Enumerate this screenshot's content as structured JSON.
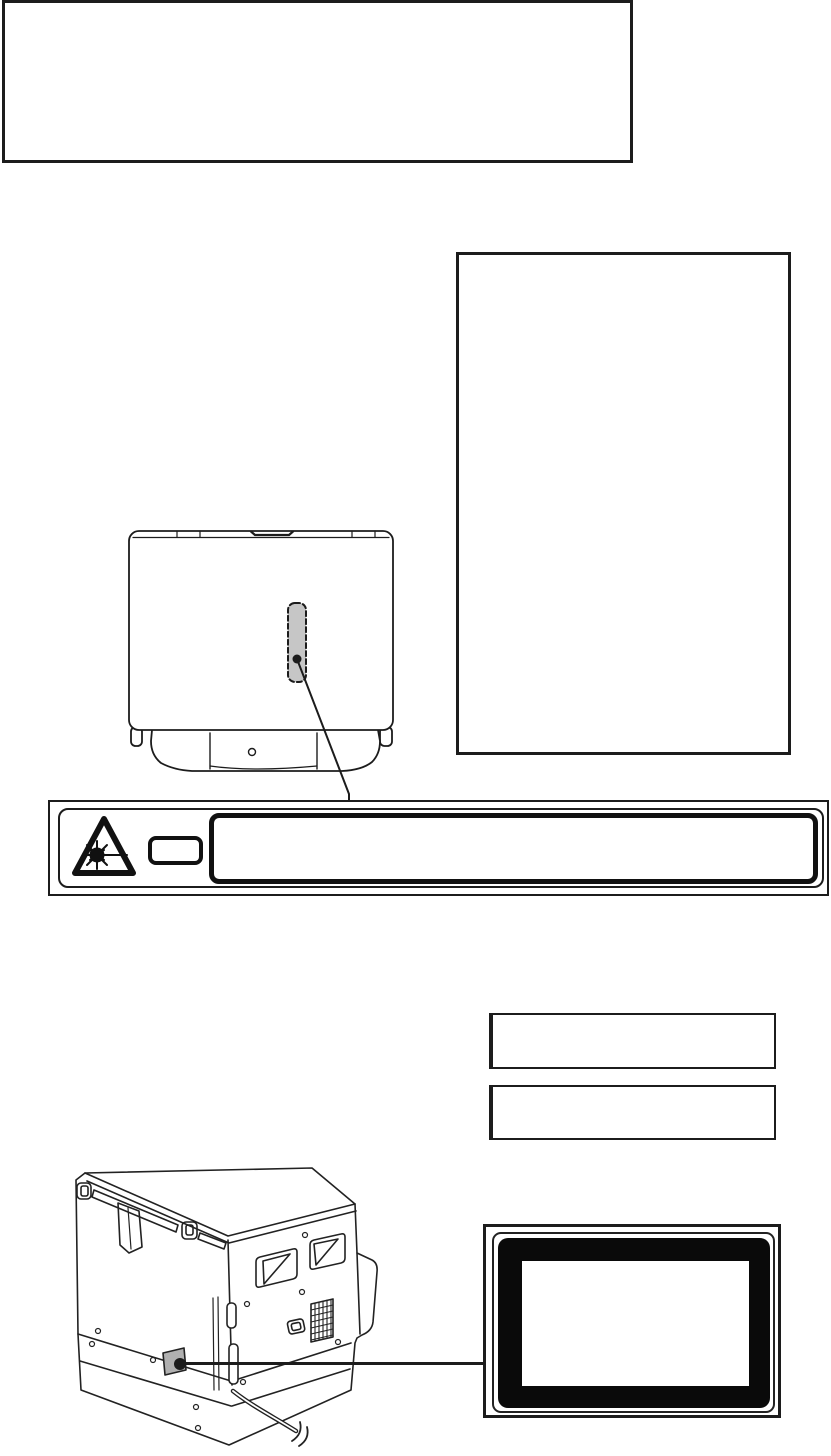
{
  "document": {
    "kind": "printer-manual-illustration-page",
    "background_color": "#ffffff",
    "line_color": "#1c1c1c",
    "gray_label_color": "#b0b0b0",
    "dashed_label_color": "#c6c6c6",
    "black_label_color": "#0a0a0a"
  },
  "regions": {
    "top_text_box": {
      "name": "top empty text box",
      "text": ""
    },
    "side_text_box": {
      "name": "right empty text box",
      "text": ""
    },
    "note_box_1": {
      "name": "small empty box 1",
      "text": ""
    },
    "note_box_2": {
      "name": "small empty box 2",
      "text": ""
    }
  },
  "figures": {
    "top_view": {
      "name": "device top view with dashed label location"
    },
    "warning_strip": {
      "name": "laser warning label strip"
    },
    "warning_parts": {
      "triangle": "laser hazard triangle icon",
      "class_box": "small class code box",
      "text_box": "large warning text box"
    },
    "rear_view": {
      "name": "copier rear view with label location and power cord"
    },
    "rating_label": {
      "name": "black framed rating label"
    }
  }
}
